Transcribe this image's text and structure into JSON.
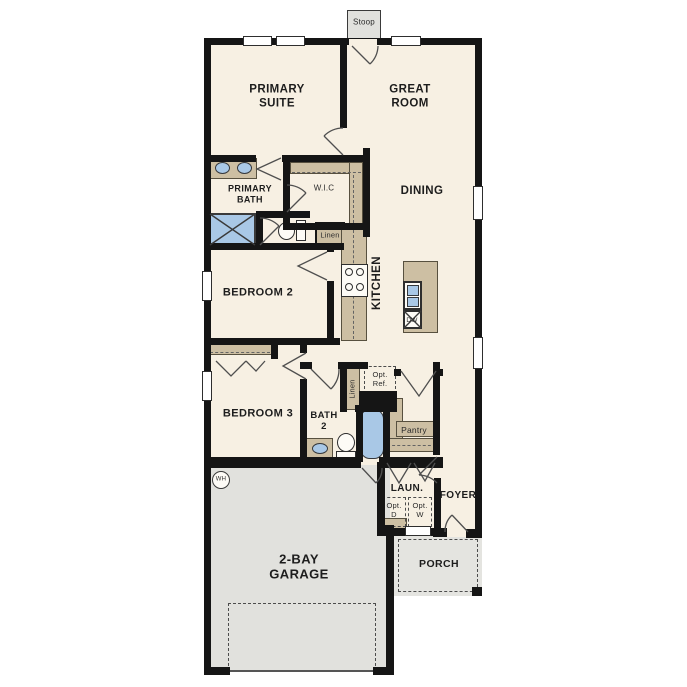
{
  "plan": {
    "title": "single-story floor plan",
    "colors": {
      "floor": "#f7f0e3",
      "garage": "#e1e1dd",
      "wall": "#151515",
      "casework": "#cdbfa3",
      "fixture_blue": "#a9c8e6"
    },
    "labels": {
      "primary_suite": "PRIMARY\nSUITE",
      "great_room": "GREAT\nROOM",
      "dining": "DINING",
      "kitchen": "KITCHEN",
      "primary_bath": "PRIMARY\nBATH",
      "wic": "W.I.C",
      "linen_hall": "Linen",
      "bedroom2": "BEDROOM 2",
      "bedroom3": "BEDROOM 3",
      "bath2": "BATH\n2",
      "linen_bath2": "Linen",
      "opt_ref": "Opt.\nRef.",
      "pantry": "Pantry",
      "laundry": "LAUN.",
      "opt_dryer": "Opt.\nD",
      "opt_washer": "Opt.\nW",
      "foyer": "FOYER",
      "porch": "PORCH",
      "garage": "2-BAY\nGARAGE",
      "stoop": "Stoop",
      "water_heater": "WH",
      "dishwasher": "DW"
    }
  }
}
